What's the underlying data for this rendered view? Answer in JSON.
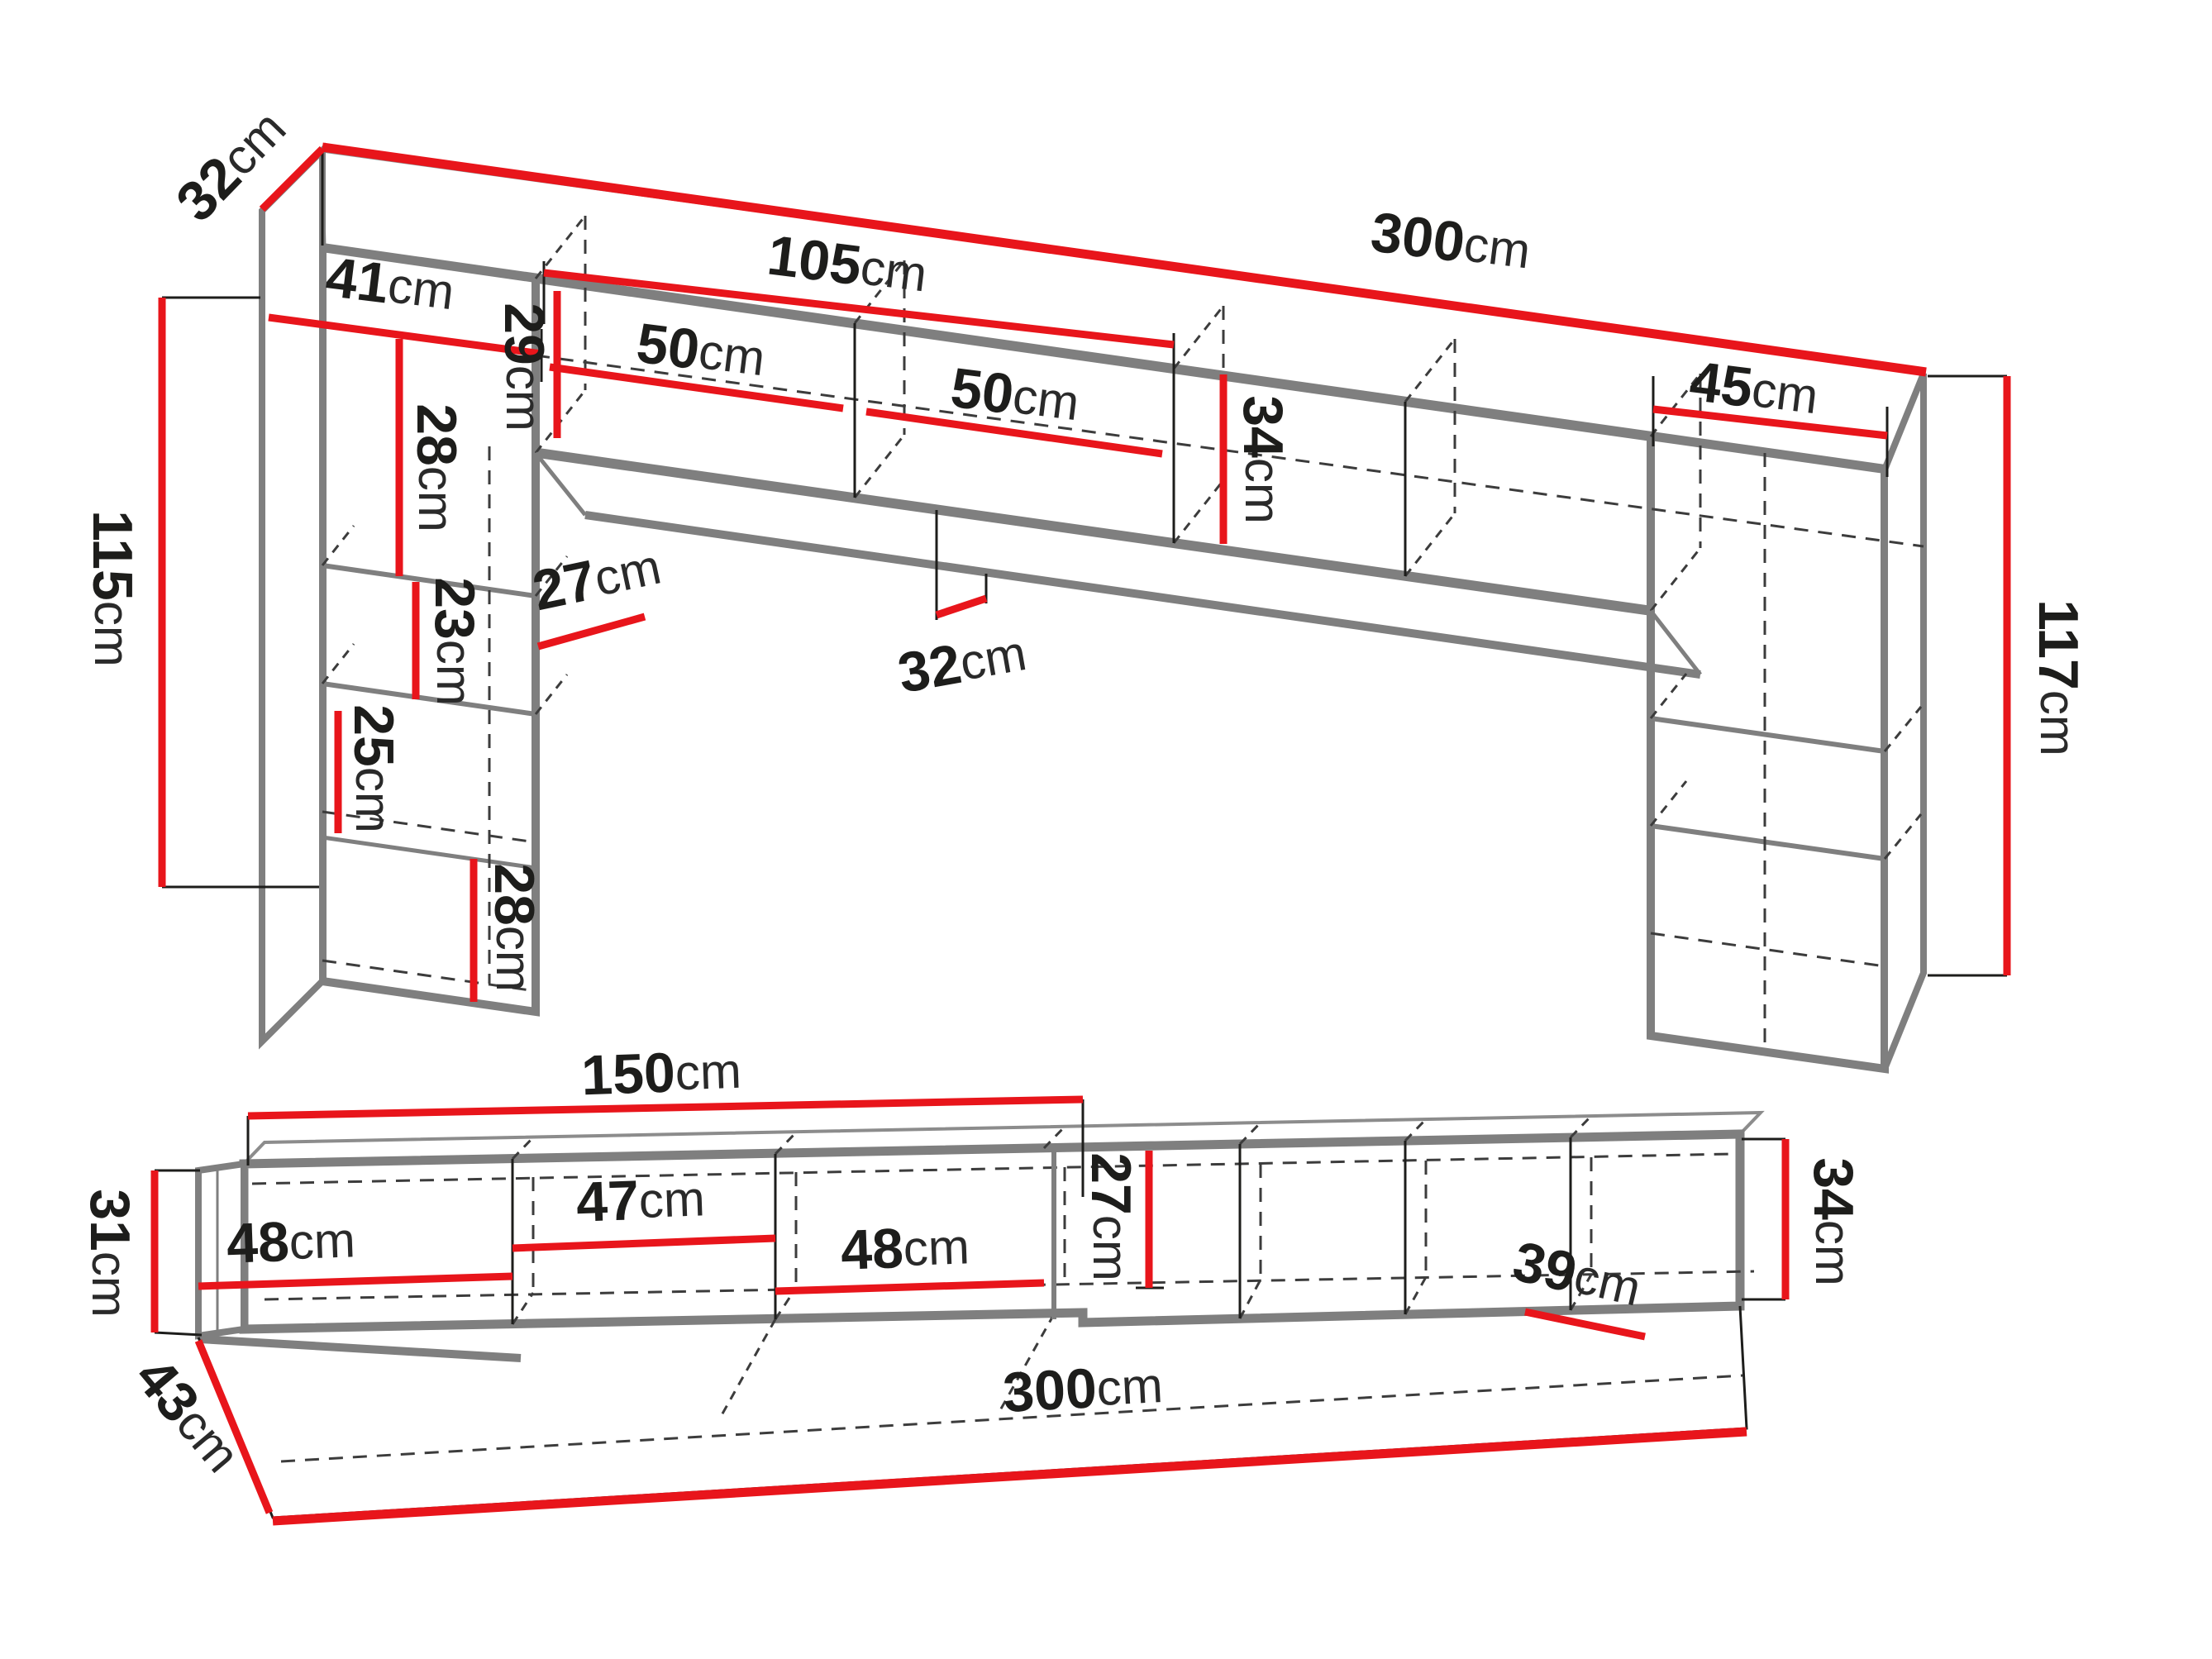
{
  "unit_suffix": "cm",
  "colors": {
    "dimension_red": "#e8151b",
    "outline_gray": "#7f7f7f",
    "line_black": "#1d1d1b",
    "dashed_gray": "#3c3c3c",
    "background": "#ffffff"
  },
  "top_drawing": {
    "name": "wall-unit-dimension-drawing",
    "dims": [
      {
        "id": "side-panel-depth-top-left",
        "v": "32",
        "u": "cm"
      },
      {
        "id": "total-width",
        "v": "300",
        "u": "cm"
      },
      {
        "id": "center-hanging-cabinet-width",
        "v": "105",
        "u": "cm"
      },
      {
        "id": "left-column-width",
        "v": "41",
        "u": "cm"
      },
      {
        "id": "left-upper-compartment-height",
        "v": "28",
        "u": "cm"
      },
      {
        "id": "left-door-width",
        "v": "50",
        "u": "cm"
      },
      {
        "id": "hanging-cabinet-inner-height",
        "v": "29",
        "u": "cm"
      },
      {
        "id": "right-door-width",
        "v": "50",
        "u": "cm"
      },
      {
        "id": "hanging-cabinet-height",
        "v": "34",
        "u": "cm"
      },
      {
        "id": "right-column-width",
        "v": "45",
        "u": "cm"
      },
      {
        "id": "left-column-height",
        "v": "115",
        "u": "cm"
      },
      {
        "id": "left-middle-compartment-height",
        "v": "23",
        "u": "cm"
      },
      {
        "id": "left-column-inner-width",
        "v": "27",
        "u": "cm"
      },
      {
        "id": "left-lower-compartment-height",
        "v": "25",
        "u": "cm"
      },
      {
        "id": "hanging-cabinet-depth",
        "v": "32",
        "u": "cm"
      },
      {
        "id": "left-bottom-door-height",
        "v": "28",
        "u": "cm"
      },
      {
        "id": "right-column-height",
        "v": "117",
        "u": "cm"
      }
    ]
  },
  "bottom_drawing": {
    "name": "tv-stand-dimension-drawing",
    "dims": [
      {
        "id": "left-half-width",
        "v": "150",
        "u": "cm"
      },
      {
        "id": "left-end-height",
        "v": "31",
        "u": "cm"
      },
      {
        "id": "compartment-1-width",
        "v": "48",
        "u": "cm"
      },
      {
        "id": "compartment-2-width",
        "v": "47",
        "u": "cm"
      },
      {
        "id": "compartment-3-width",
        "v": "48",
        "u": "cm"
      },
      {
        "id": "inner-height",
        "v": "27",
        "u": "cm"
      },
      {
        "id": "right-compartment-width",
        "v": "39",
        "u": "cm"
      },
      {
        "id": "right-end-height",
        "v": "34",
        "u": "cm"
      },
      {
        "id": "total-width",
        "v": "300",
        "u": "cm"
      },
      {
        "id": "depth",
        "v": "43",
        "u": "cm"
      }
    ]
  }
}
